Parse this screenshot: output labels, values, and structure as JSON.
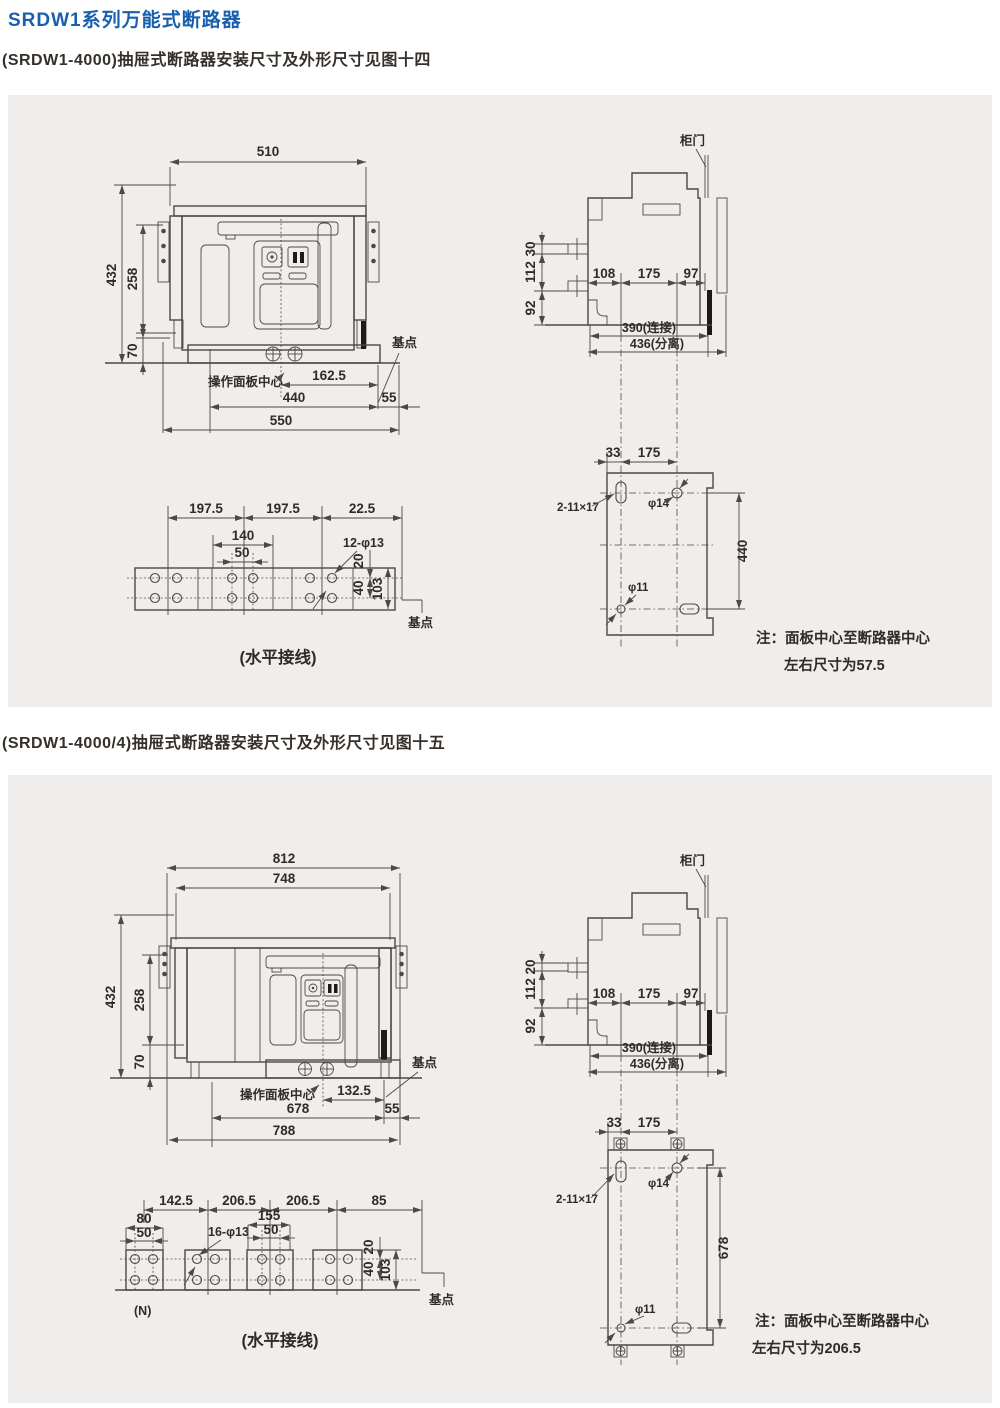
{
  "colors": {
    "title_blue": "#1a5fad",
    "text_dark": "#2f2b27",
    "line": "#4d4944",
    "panel_bg": "#efeeec",
    "page_bg": "#ffffff"
  },
  "page": {
    "title": "SRDW1系列万能式断路器",
    "section1": "(SRDW1-4000)抽屉式断路器安装尺寸及外形尺寸见图十四",
    "section2": "(SRDW1-4000/4)抽屉式断路器安装尺寸及外形尺寸见图十五"
  },
  "fig14": {
    "front": {
      "w510": "510",
      "h432": "432",
      "h258": "258",
      "h70": "70",
      "panel_center": "操作面板中心",
      "d162_5": "162.5",
      "d440": "440",
      "d55": "55",
      "d550": "550",
      "base_point": "基点"
    },
    "side": {
      "door": "柜门",
      "d30": "30",
      "d112": "112",
      "d92": "92",
      "d108": "108",
      "d175": "175",
      "d97": "97",
      "d390": "390(连接)",
      "d436": "436(分离)"
    },
    "plate": {
      "d33": "33",
      "d175": "175",
      "slot": "2-11×17",
      "d14": "φ14",
      "d440": "440",
      "d11": "φ11"
    },
    "bottom": {
      "d197a": "197.5",
      "d197b": "197.5",
      "d22_5": "22.5",
      "d140": "140",
      "d50": "50",
      "holes": "12-φ13",
      "d20": "20",
      "d40": "40",
      "d103": "103",
      "base_point": "基点",
      "caption": "(水平接线)"
    },
    "note_l1": "注：面板中心至断路器中心",
    "note_l2": "左右尺寸为57.5"
  },
  "fig15": {
    "front": {
      "w812": "812",
      "w748": "748",
      "h432": "432",
      "h258": "258",
      "h70": "70",
      "panel_center": "操作面板中心",
      "d132_5": "132.5",
      "d678": "678",
      "d55": "55",
      "d788": "788",
      "base_point": "基点"
    },
    "side": {
      "door": "柜门",
      "d20": "20",
      "d112": "112",
      "d92": "92",
      "d108": "108",
      "d175": "175",
      "d97": "97",
      "d390": "390(连接)",
      "d436": "436(分离)"
    },
    "plate": {
      "d33": "33",
      "d175": "175",
      "slot": "2-11×17",
      "d14": "φ14",
      "d678": "678",
      "d11": "φ11"
    },
    "bottom": {
      "d142_5": "142.5",
      "d206a": "206.5",
      "d206b": "206.5",
      "d85": "85",
      "d80": "80",
      "d50a": "50",
      "holes": "16-φ13",
      "d155": "155",
      "d50b": "50",
      "d20": "20",
      "d40": "40",
      "d103": "103",
      "n": "(N)",
      "base_point": "基点",
      "caption": "(水平接线)"
    },
    "note_l1": "注：面板中心至断路器中心",
    "note_l2": "左右尺寸为206.5"
  }
}
